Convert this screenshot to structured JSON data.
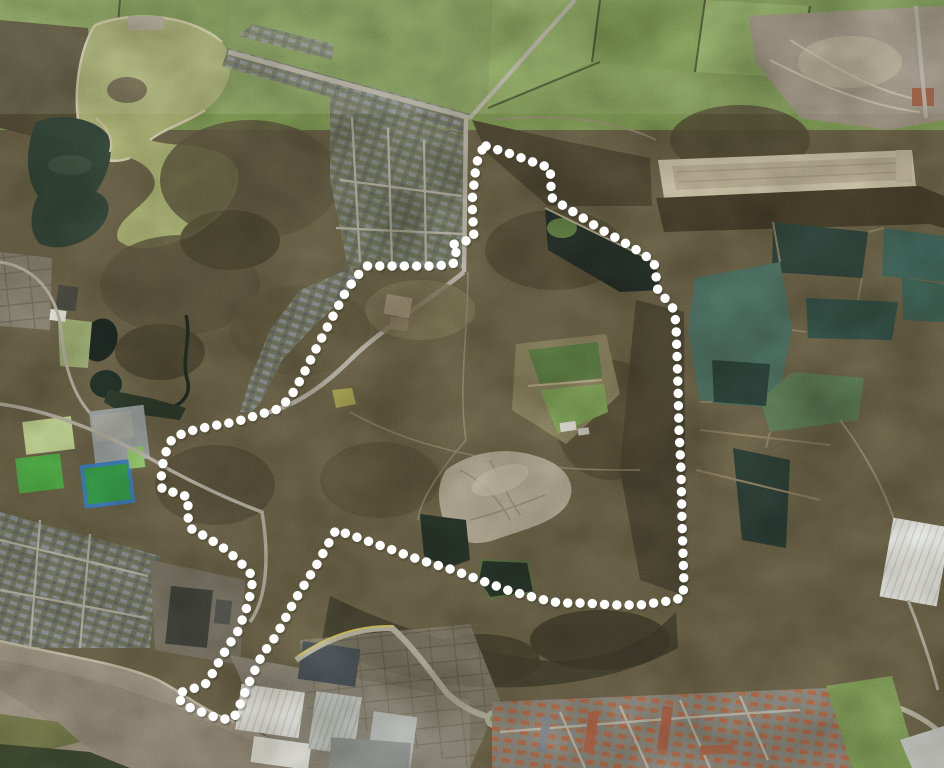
{
  "canvas": {
    "width": 944,
    "height": 768
  },
  "scene": {
    "kind": "aerial-photograph",
    "overlay": "dotted site boundary"
  },
  "palette": {
    "heath": "#6b6349",
    "woodland": "#4a4431",
    "field_green": "#7f9b56",
    "pale_pitch": "#c3d794",
    "bright_pitch": "#4fae47",
    "blue_pitch_border": "#3f7ec2",
    "lake_dark": "#2f4238",
    "lagoon_teal": "#4d7164",
    "river": "#a09686",
    "road": "#b5b1a4",
    "village_roof": "#7e838a",
    "red_roof": "#b2664a",
    "industrial_white": "#e9eae6",
    "quarry": "#9d9383",
    "bare_spoil": "#b2a994",
    "boundary": "#ffffff"
  },
  "boundary": {
    "color": "#ffffff",
    "shadow_color": "rgba(40,40,30,0.35)",
    "dot_diameter": 9.4,
    "dot_spacing": 12.2,
    "closed": true,
    "points": [
      [
        486,
        146
      ],
      [
        508,
        153
      ],
      [
        530,
        161
      ],
      [
        550,
        168
      ],
      [
        551,
        182
      ],
      [
        551,
        197
      ],
      [
        559,
        203
      ],
      [
        580,
        216
      ],
      [
        600,
        229
      ],
      [
        620,
        240
      ],
      [
        640,
        252
      ],
      [
        654,
        262
      ],
      [
        656,
        276
      ],
      [
        658,
        292
      ],
      [
        668,
        301
      ],
      [
        674,
        310
      ],
      [
        676,
        324
      ],
      [
        678,
        386
      ],
      [
        679,
        430
      ],
      [
        681,
        470
      ],
      [
        682,
        520
      ],
      [
        684,
        586
      ],
      [
        682,
        598
      ],
      [
        668,
        601
      ],
      [
        640,
        605
      ],
      [
        612,
        605
      ],
      [
        584,
        603
      ],
      [
        560,
        603
      ],
      [
        540,
        599
      ],
      [
        510,
        591
      ],
      [
        480,
        580
      ],
      [
        450,
        569
      ],
      [
        420,
        560
      ],
      [
        390,
        549
      ],
      [
        362,
        539
      ],
      [
        336,
        530
      ],
      [
        316,
        566
      ],
      [
        295,
        600
      ],
      [
        276,
        636
      ],
      [
        262,
        655
      ],
      [
        248,
        685
      ],
      [
        237,
        712
      ],
      [
        233,
        719
      ],
      [
        220,
        719
      ],
      [
        204,
        713
      ],
      [
        186,
        706
      ],
      [
        178,
        698
      ],
      [
        179,
        693
      ],
      [
        188,
        690
      ],
      [
        199,
        687
      ],
      [
        207,
        683
      ],
      [
        216,
        667
      ],
      [
        227,
        648
      ],
      [
        238,
        631
      ],
      [
        246,
        610
      ],
      [
        251,
        592
      ],
      [
        253,
        577
      ],
      [
        246,
        568
      ],
      [
        228,
        551
      ],
      [
        208,
        538
      ],
      [
        190,
        528
      ],
      [
        188,
        517
      ],
      [
        188,
        497
      ],
      [
        176,
        493
      ],
      [
        162,
        489
      ],
      [
        161,
        479
      ],
      [
        163,
        463
      ],
      [
        168,
        445
      ],
      [
        174,
        437
      ],
      [
        190,
        431
      ],
      [
        212,
        426
      ],
      [
        235,
        422
      ],
      [
        258,
        415
      ],
      [
        278,
        409
      ],
      [
        290,
        398
      ],
      [
        302,
        377
      ],
      [
        316,
        349
      ],
      [
        330,
        322
      ],
      [
        344,
        295
      ],
      [
        356,
        277
      ],
      [
        367,
        266
      ],
      [
        390,
        266
      ],
      [
        414,
        266
      ],
      [
        434,
        266
      ],
      [
        446,
        265
      ],
      [
        455,
        263
      ],
      [
        456,
        252
      ],
      [
        451,
        245
      ],
      [
        463,
        242
      ],
      [
        474,
        238
      ],
      [
        473,
        220
      ],
      [
        472,
        202
      ],
      [
        474,
        184
      ],
      [
        476,
        166
      ],
      [
        480,
        152
      ],
      [
        486,
        146
      ]
    ]
  }
}
